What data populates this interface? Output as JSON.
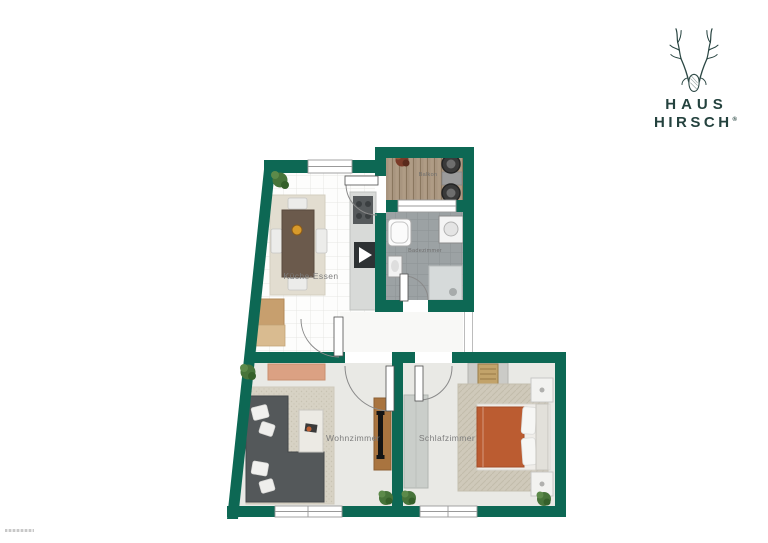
{
  "logo": {
    "name_line1": "HAUS",
    "name_line2": "HIRSCH",
    "registered_mark": "®",
    "icon": "stag-antlers-icon",
    "text_color": "#24423e"
  },
  "floor_plan": {
    "wall_color": "#0d6854",
    "colors": {
      "balcony_wood": "#a8957f",
      "bathroom_tile": "#9ca2a4",
      "bed_duvet": "#bb5c31",
      "room_floor": "#e9e9e5",
      "sofa": "#54585a"
    },
    "rooms": [
      {
        "id": "kitchen_dining",
        "label": "Küche-Essen"
      },
      {
        "id": "balcony",
        "label": "Balkon"
      },
      {
        "id": "bathroom",
        "label": "Badezimmer"
      },
      {
        "id": "living_room",
        "label": "Wohnzimmer"
      },
      {
        "id": "bedroom",
        "label": "Schlafzimmer"
      }
    ]
  }
}
